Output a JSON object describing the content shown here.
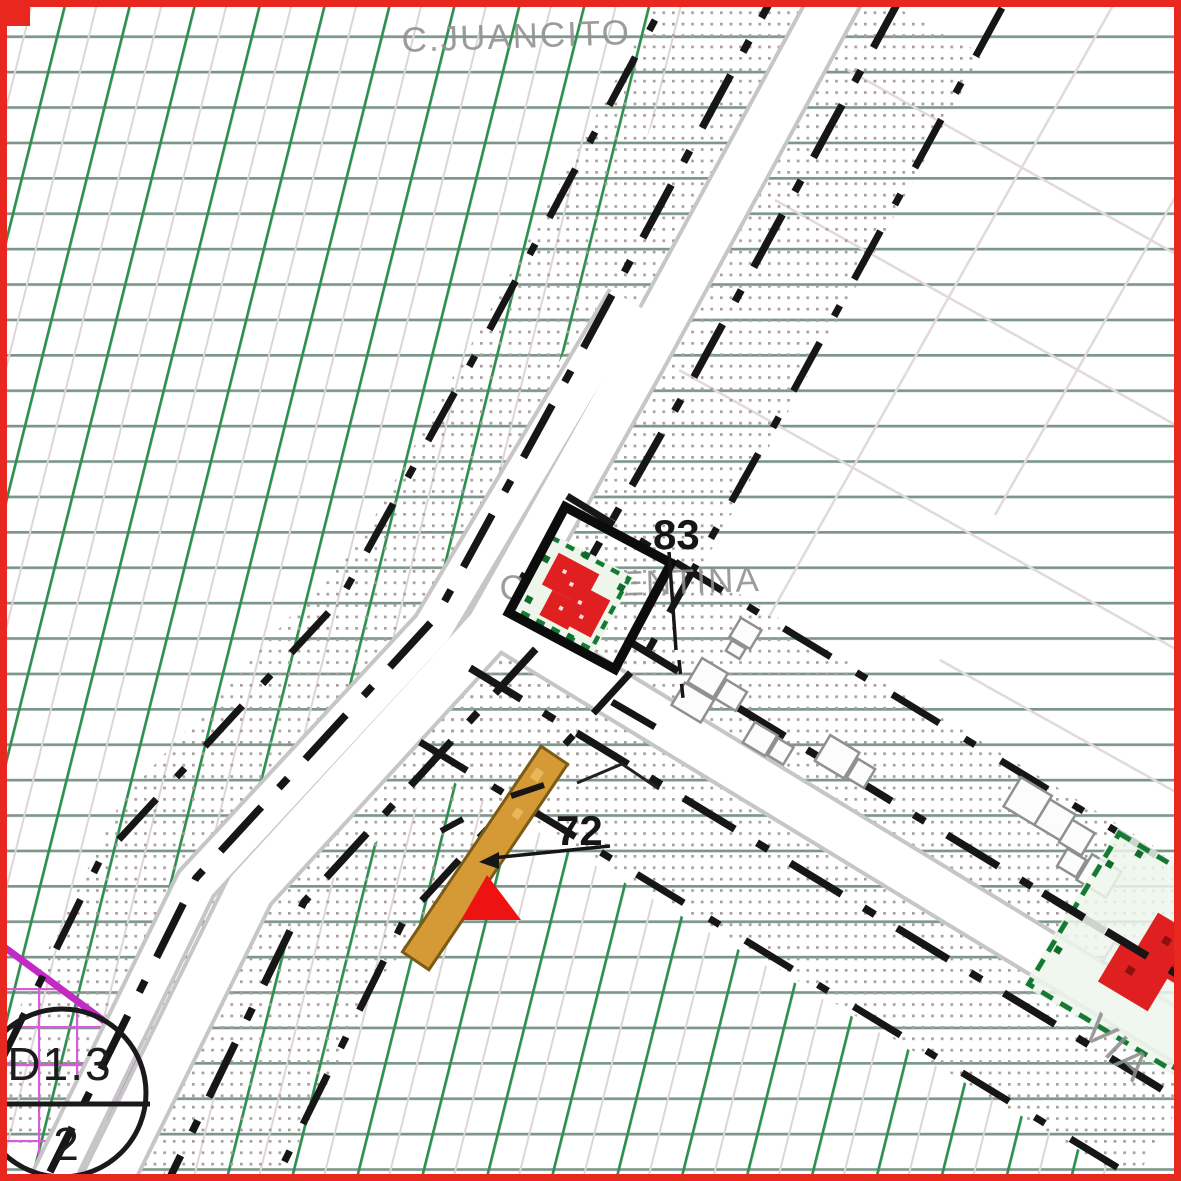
{
  "title": "Cadastral zoning plan detail",
  "labels": {
    "street_top": "C.JUANCITO",
    "street_mid": "C.ARGENTINA",
    "via": "VIA",
    "parcel_selected": "83",
    "parcel_strip": "72"
  },
  "zone_badge": {
    "code": "D1.3",
    "number": "2"
  },
  "colors": {
    "map_border": "#e8281e",
    "green_hatch": "#2e8f50",
    "horizontal_grid": "#7d968c",
    "stipple_dots": "#a89f9c",
    "road_edge": "#c6c6c6",
    "boundary_dash": "#161616",
    "highlight_square": "#0c0c0c",
    "building_red": "#e02020",
    "parcel_green": "#157a33",
    "strip_orange": "#d59a35",
    "zone_magenta": "#c32ac3",
    "label_gray": "#8f8f8f"
  }
}
